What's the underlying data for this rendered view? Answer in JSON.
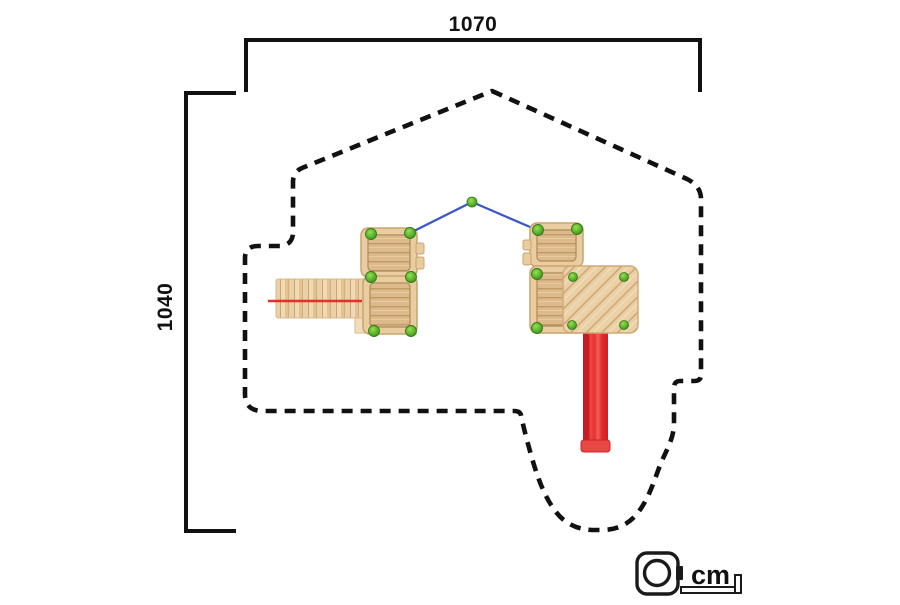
{
  "diagram": {
    "type": "playground-equipment-top-view-dimension-drawing",
    "width_dimension": "1070",
    "height_dimension": "1040",
    "unit_label": "cm"
  },
  "elements": {
    "safety_zone": "dashed-outline",
    "left_tower_platforms": 2,
    "right_tower_platforms": 3,
    "walkway": "plank-bridge-left",
    "slide": "red-slide-down",
    "rope": "blue-v-rope-with-center-post",
    "corner_posts": "green-ball-caps"
  },
  "icons": {
    "tape_measure": "tape-measure-icon"
  },
  "colors": {
    "outline_dashed": "#111111",
    "dimension_lines": "#111111",
    "wood_light": "#f0d9b4",
    "wood_mid": "#e2c193",
    "wood_line": "#c9a475",
    "deck_wood": "#dcba8b",
    "slide_red": "#e63230",
    "slide_rail_red": "#c81c24",
    "section_red_line": "#e23128",
    "rope_blue": "#3a57c9",
    "post_green": "#5cb52e",
    "background": "#ffffff"
  }
}
